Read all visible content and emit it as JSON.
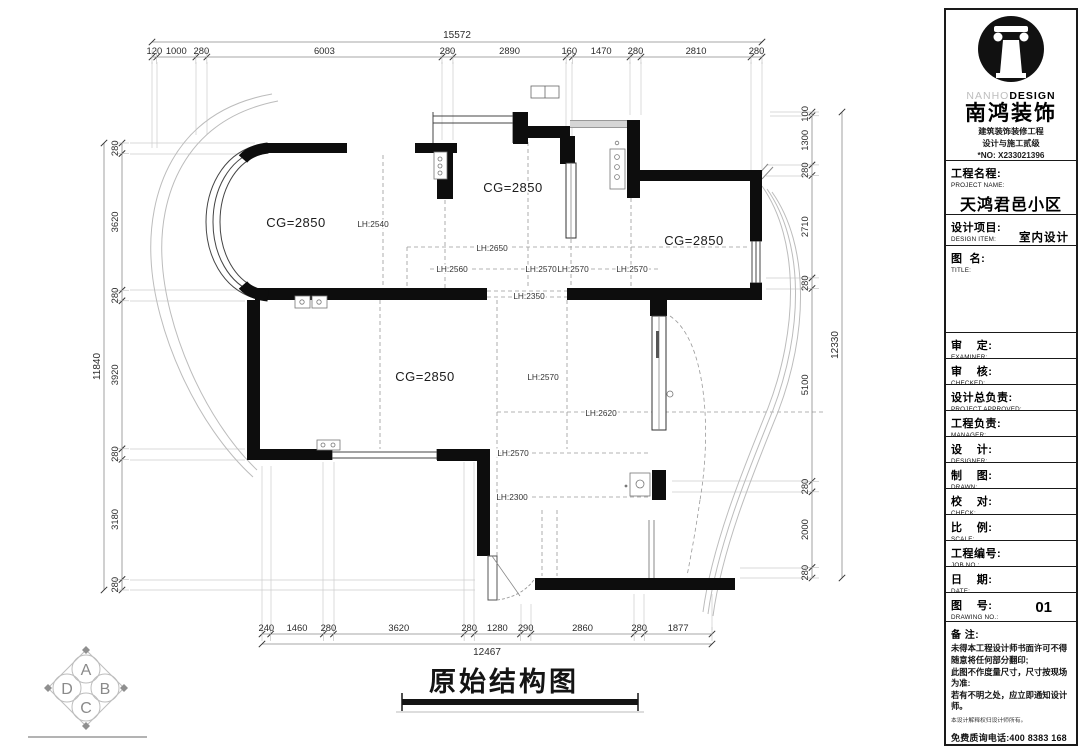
{
  "company": {
    "brand_en_light": "NANHO",
    "brand_en_bold": "DESIGN",
    "brand_cn": "南鸿装饰",
    "cert_line1": "建筑装饰装修工程",
    "cert_line2": "设计与施工贰级",
    "cert_no": "*NO: X233021396"
  },
  "title_block": {
    "project": {
      "label_cn": "工程名程:",
      "label_en": "PROJECT NAME:",
      "value": "天鸿君邑小区"
    },
    "design_item": {
      "label_cn": "设计项目:",
      "label_en": "DESIGN ITEM:",
      "value": "室内设计"
    },
    "title_field": {
      "label_cn": "图  名:",
      "label_en": "TITLE:",
      "value": ""
    },
    "rows": [
      {
        "label_cn": "审    定:",
        "label_en": "EXAMINER:"
      },
      {
        "label_cn": "审    核:",
        "label_en": "CHECKED:"
      },
      {
        "label_cn": "设计总负责:",
        "label_en": "PROJECT APPROVED:"
      },
      {
        "label_cn": "工程负责:",
        "label_en": "MANAGER:"
      },
      {
        "label_cn": "设    计:",
        "label_en": "DESIGNER:"
      },
      {
        "label_cn": "制    图:",
        "label_en": "DRAWN:"
      },
      {
        "label_cn": "校    对:",
        "label_en": "CHECK:"
      },
      {
        "label_cn": "比    例:",
        "label_en": "SCALE:"
      },
      {
        "label_cn": "工程编号:",
        "label_en": "JOB  NO.:"
      },
      {
        "label_cn": "日    期:",
        "label_en": "DATE:"
      }
    ],
    "drawing_no": {
      "label_cn": "图    号:",
      "label_en": "DRAWING NO.:",
      "value": "01"
    },
    "notes": {
      "label_cn": "备 注:",
      "lines": [
        "未得本工程设计师书面许可不得",
        "随意将任何部分翻印;",
        "此图不作度量尺寸，尺寸按现场",
        "为准:",
        "若有不明之处，应立即通知设计",
        "师。"
      ],
      "fine_print": "本设计解释权归设计师所有。",
      "hotline": "免费质询电话:400 8383 168"
    }
  },
  "drawing": {
    "title": "原始结构图",
    "room_labels": [
      {
        "text": "CG=2850",
        "x": 296,
        "y": 227
      },
      {
        "text": "CG=2850",
        "x": 513,
        "y": 192
      },
      {
        "text": "CG=2850",
        "x": 694,
        "y": 245
      },
      {
        "text": "CG=2850",
        "x": 425,
        "y": 381
      }
    ],
    "lh_labels": [
      {
        "text": "LH:2540",
        "x": 373,
        "y": 227
      },
      {
        "text": "LH:2650",
        "x": 492,
        "y": 251
      },
      {
        "text": "LH:2560",
        "x": 452,
        "y": 272
      },
      {
        "text": "LH:2570",
        "x": 541,
        "y": 272
      },
      {
        "text": "LH:2570",
        "x": 573,
        "y": 272
      },
      {
        "text": "LH:2570",
        "x": 632,
        "y": 272
      },
      {
        "text": "LH:2350",
        "x": 529,
        "y": 299
      },
      {
        "text": "LH:2570",
        "x": 543,
        "y": 380
      },
      {
        "text": "LH:2620",
        "x": 601,
        "y": 416
      },
      {
        "text": "LH:2570",
        "x": 513,
        "y": 456
      },
      {
        "text": "LH:2300",
        "x": 512,
        "y": 500
      }
    ],
    "dims": {
      "top": {
        "total": "15572",
        "segments": [
          120,
          1000,
          280,
          6003,
          280,
          2890,
          160,
          1470,
          280,
          2810,
          280
        ]
      },
      "bottom": {
        "total": "12467",
        "segments": [
          240,
          1460,
          280,
          3620,
          280,
          1280,
          290,
          2860,
          280,
          1877
        ]
      },
      "left": {
        "total": "11840",
        "segments": [
          280,
          3620,
          280,
          3920,
          280,
          3180,
          280
        ]
      },
      "right": {
        "total": "12330",
        "segments": [
          100,
          1300,
          280,
          2710,
          280,
          5100,
          280,
          2000,
          280
        ]
      }
    }
  },
  "stamp": {
    "letters": [
      "A",
      "B",
      "C",
      "D"
    ]
  }
}
